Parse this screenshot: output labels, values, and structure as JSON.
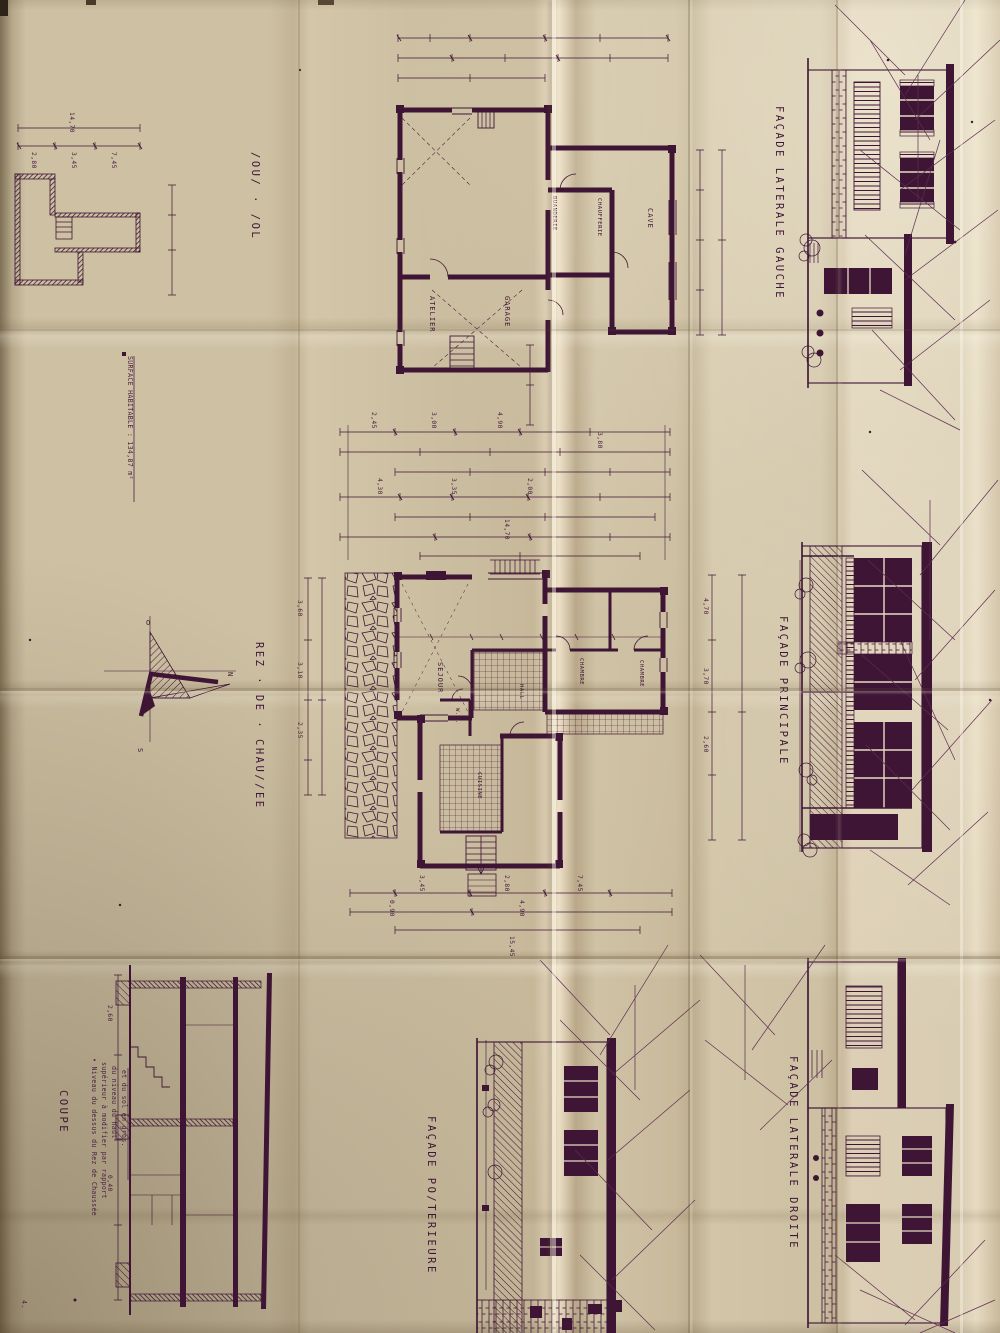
{
  "colors": {
    "ink": "#3f1535",
    "ink_soft": "#5e2c50",
    "paper": "#cdc0a3",
    "paper_light": "#e6dbc2",
    "paper_shadow": "#9b8c6f"
  },
  "labels": {
    "sous_sol": "/OU/ · /OL",
    "facade_laterale_gauche": "FAÇADE  LATERALE  GAUCHE",
    "rez_de_chaussee": "REZ · DE · CHAU//EE",
    "facade_principale": "FAÇADE  PRINCIPALE",
    "coupe": "COUPE",
    "facade_posterieure": "FAÇADE  PO/TERIEURE",
    "facade_laterale_droite": "FAÇADE  LATERALE  DROITE"
  },
  "notes": {
    "surface": "SURFACE HABITABLE : 134,87 m²",
    "coupe_note_lines": [
      "• Niveau du dessus du Rez de Chaussée",
      "supérieur à modifier par rapport",
      "du niveau du haut",
      "et du sol en gros."
    ],
    "corner_mark": "4."
  },
  "compass": {
    "top": "O",
    "right": "N",
    "bottom": "S"
  },
  "plans": {
    "sous_sol": {
      "rooms": [
        "ATELIER",
        "GARAGE",
        "CAVE",
        "BUANDERIE",
        "CHAUFFERIE"
      ]
    },
    "rez": {
      "rooms": [
        "SEJOUR",
        "CHAMBRE",
        "CHAMBRE",
        "CUISINE",
        "HALL",
        "W.C."
      ]
    }
  },
  "dims": {
    "mini_top": [
      "14,70",
      "2,80",
      "3,45",
      "7,45"
    ],
    "mid": [
      "2,45",
      "3,00",
      "4,90",
      "4,30",
      "3,35",
      "2,00",
      "14,70",
      "3,80"
    ],
    "rez_bottom": [
      "3,45",
      "2,80",
      "7,45",
      "0,90",
      "4,90",
      "15,45"
    ],
    "right_vert": [
      "4,70",
      "3,70",
      "2,60"
    ],
    "left_vert": [
      "3,60",
      "3,10",
      "2,35"
    ],
    "coupe": [
      "2,60",
      "0,40"
    ]
  }
}
